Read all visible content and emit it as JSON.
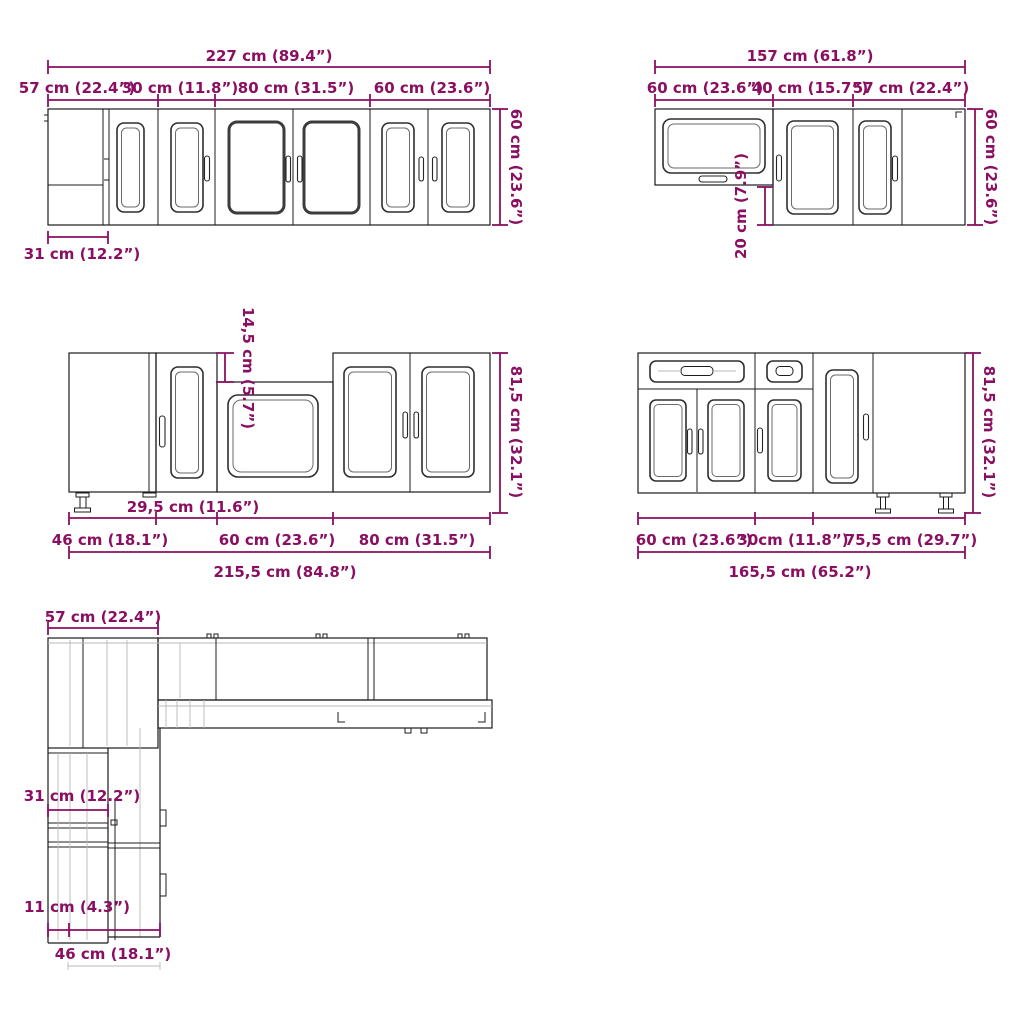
{
  "colors": {
    "accent": "#8a0f62",
    "line": "#1c1c1c"
  },
  "diagrams": {
    "top_left": {
      "total": "227 cm (89.4”)",
      "segments": [
        "57 cm (22.4”)",
        "30 cm (11.8”)",
        "80 cm (31.5”)",
        "60 cm (23.6”)"
      ],
      "height": "60 cm (23.6”)",
      "depth": "31 cm (12.2”)"
    },
    "top_right": {
      "total": "157 cm (61.8”)",
      "segments": [
        "60 cm (23.6”)",
        "40 cm (15.7”)",
        "57 cm (22.4”)"
      ],
      "height": "60 cm (23.6”)",
      "drop": "20 cm (7.9”)"
    },
    "mid_left": {
      "recess": "14,5 cm (5.7”)",
      "height": "81,5 cm (32.1”)",
      "inset": "29,5 cm (11.6”)",
      "segments": [
        "46 cm (18.1”)",
        "60 cm (23.6”)",
        "80 cm (31.5”)"
      ],
      "total": "215,5 cm (84.8”)"
    },
    "mid_right": {
      "height": "81,5 cm (32.1”)",
      "segments": [
        "60 cm (23.6”)",
        "30cm (11.8”)",
        "75,5 cm (29.7”)"
      ],
      "total": "165,5 cm (65.2”)"
    },
    "bottom_plan": {
      "width": "57 cm (22.4”)",
      "wall_depth": "31 cm (12.2”)",
      "gap": "11 cm (4.3”)",
      "base_depth": "46 cm (18.1”)"
    }
  }
}
